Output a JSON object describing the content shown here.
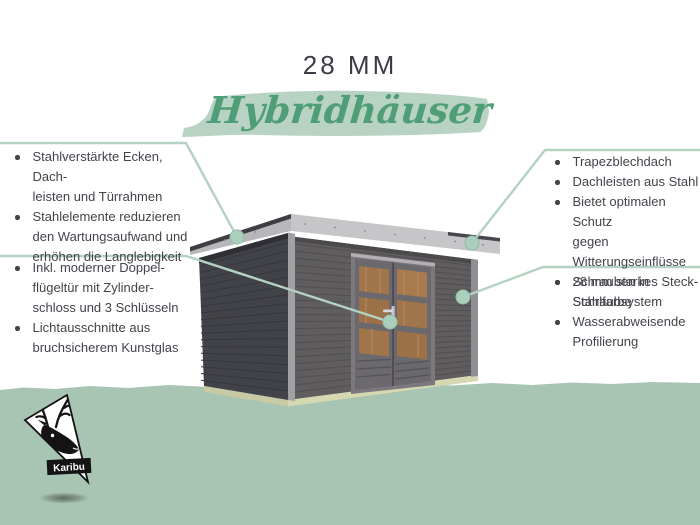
{
  "title": "28 MM",
  "subtitle": "Hybridhäuser",
  "brand": {
    "name": "Karibu"
  },
  "callouts": {
    "top_left": {
      "items": [
        [
          "Stahlverstärkte Ecken, Dach-",
          "leisten und Türrahmen"
        ],
        [
          "Stahlelemente reduzieren",
          "den Wartungsaufwand und",
          "erhöhen die Langlebigkeit"
        ]
      ]
    },
    "bottom_left": {
      "items": [
        [
          "Inkl. moderner Doppel-",
          "flügeltür mit Zylinder-",
          "schloss und 3 Schlüsseln"
        ],
        [
          "Lichtausschnitte aus",
          "bruchsicherem Kunstglas"
        ]
      ]
    },
    "top_right": {
      "items": [
        [
          "Trapezblechdach"
        ],
        [
          "Dachleisten aus Stahl"
        ],
        [
          "Bietet optimalen Schutz",
          "gegen Witterungseinflüsse"
        ],
        [
          "Schrauben in Stahlfarbe"
        ]
      ]
    },
    "bottom_right": {
      "items": [
        [
          "28 mm starkes Steck-",
          "Schraubsystem"
        ],
        [
          "Wasserabweisende",
          "Profilierung"
        ]
      ]
    }
  },
  "colors": {
    "accent_green": "#4f9e78",
    "brush_green": "#b8d2c3",
    "callout_line_green": "#b3d2c1",
    "ground_green": "#a8c4b2",
    "text_dark": "#43434b",
    "shed_front_wall": "#5f5d5e",
    "shed_side_wall": "#424348",
    "roof_steel": "#c6c5c7",
    "door_wood": "#a0754a"
  }
}
